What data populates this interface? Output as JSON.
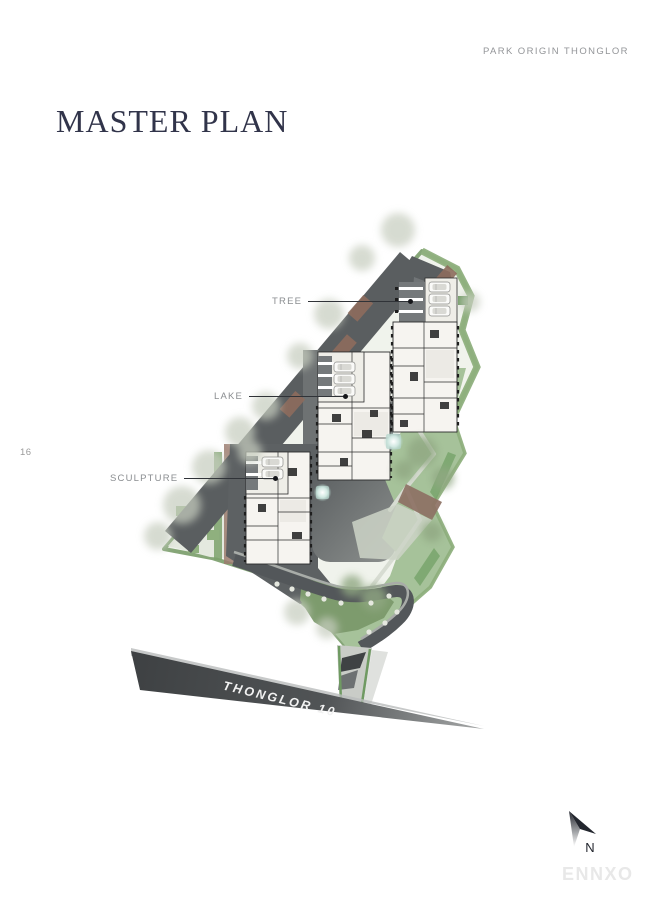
{
  "header": {
    "brand": "PARK ORIGIN THONGLOR"
  },
  "title": "MASTER PLAN",
  "page_number": "16",
  "plan": {
    "callouts": [
      {
        "id": "tree",
        "label": "TREE"
      },
      {
        "id": "lake",
        "label": "LAKE"
      },
      {
        "id": "sculpture",
        "label": "SCULPTURE"
      }
    ],
    "road_label": "THONGLOR 10"
  },
  "compass": {
    "label": "N"
  },
  "watermark": "ENNXO",
  "colors": {
    "page_background": "#ffffff",
    "title_text": "#31344a",
    "muted_text": "#939598",
    "callout_text": "#8a8d90",
    "callout_line": "#303338",
    "road_dark": "#3e4143",
    "road_light": "#a7a9a9",
    "road_label_text": "#f2f2f2",
    "site_edge_green": "#86a678",
    "garden_green": "#a6c29a",
    "hardscape_gray": "#5a5e60",
    "building_white": "#f6f4f0",
    "water": "#cfe7e0",
    "planter_brown": "#8d6c5d",
    "watermark_text": "#e8e8e8"
  }
}
